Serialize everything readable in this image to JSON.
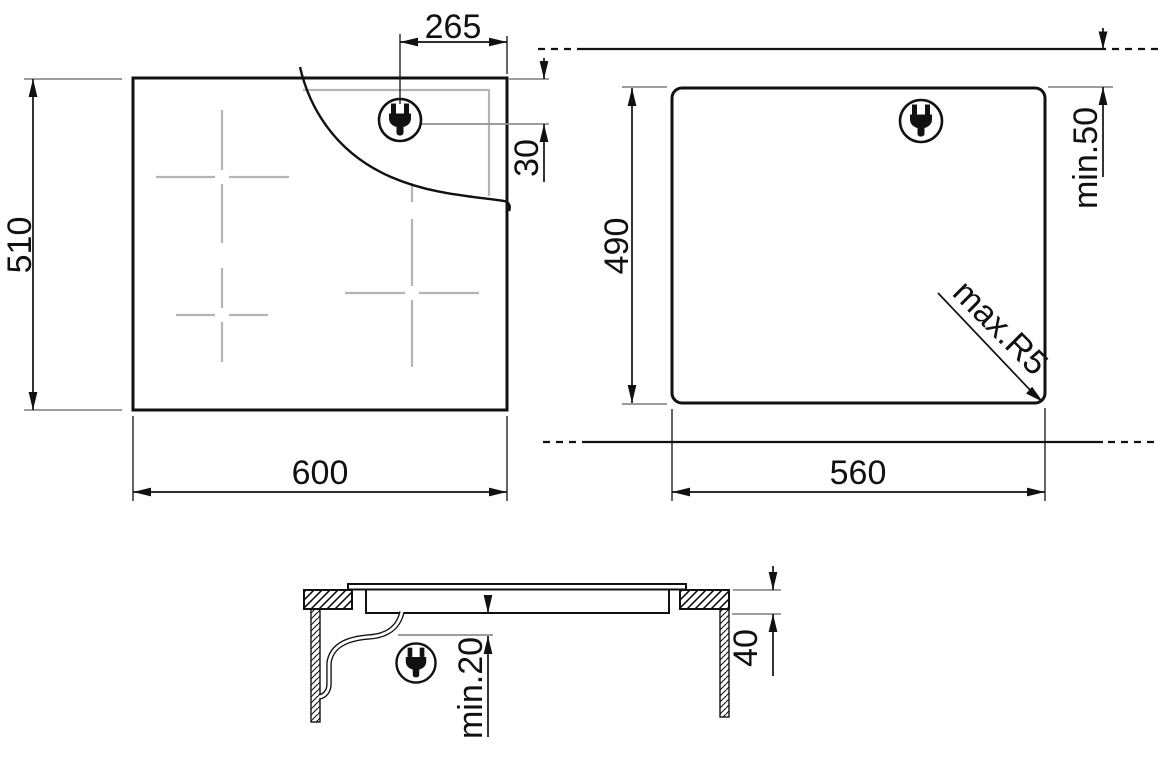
{
  "top_view": {
    "width": "600",
    "depth": "510",
    "plug_offset_x": "265",
    "plug_offset_y": "30"
  },
  "cutout_view": {
    "width": "560",
    "depth": "490",
    "rear_clearance": "min.50",
    "corner_radius": "max.R5"
  },
  "side_view": {
    "underside_clearance": "min.20",
    "recess_depth": "40"
  },
  "icons": {
    "plug": "power-plug"
  },
  "colors": {
    "ink": "#111111",
    "glass_marks": "#b4b4b4",
    "extension_gray": "#8f8f8f",
    "background": "#ffffff"
  }
}
